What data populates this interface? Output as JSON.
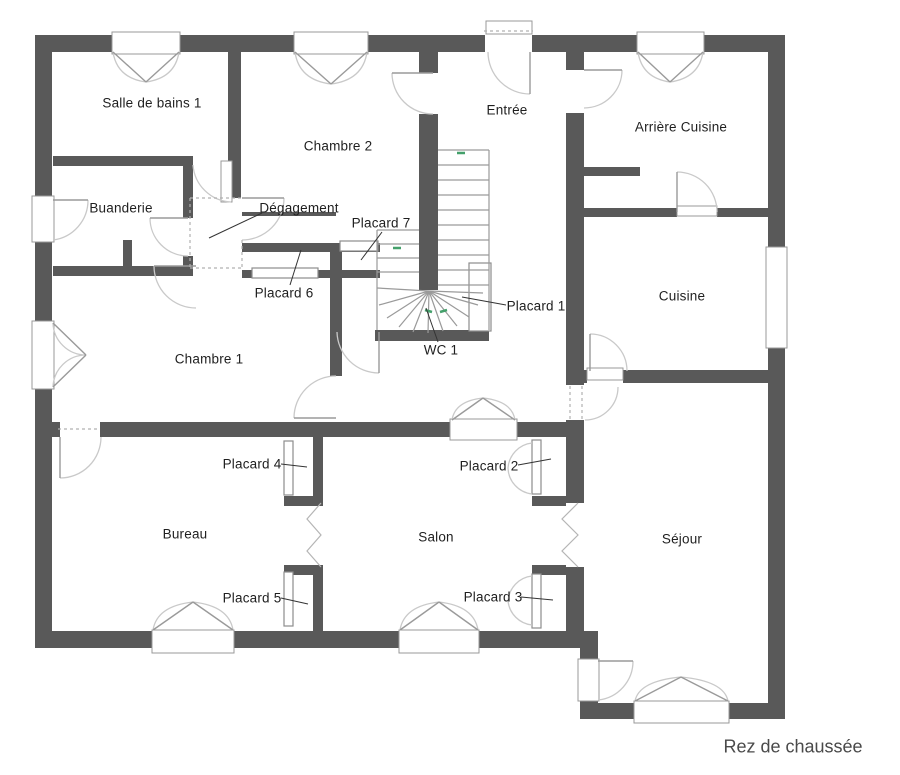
{
  "title": "Rez de chaussée",
  "colors": {
    "wall": "#595959",
    "door_arc": "#c9c9c9",
    "door_leaf": "#9a9a9a",
    "window_border": "#999999",
    "stair_line": "#9a9a9a",
    "direction_mark": "#44a06b",
    "label_text": "#1f1f1f",
    "title_text": "#4a4a4a",
    "background": "#ffffff"
  },
  "rooms": [
    {
      "label": "Salle de bains 1"
    },
    {
      "label": "Chambre 2"
    },
    {
      "label": "Entrée"
    },
    {
      "label": "Arrière Cuisine"
    },
    {
      "label": "Buanderie"
    },
    {
      "label": "Dégagement"
    },
    {
      "label": "Placard 7"
    },
    {
      "label": "Placard 6"
    },
    {
      "label": "Placard 1"
    },
    {
      "label": "Cuisine"
    },
    {
      "label": "Chambre 1"
    },
    {
      "label": "WC 1"
    },
    {
      "label": "Placard 4"
    },
    {
      "label": "Placard 2"
    },
    {
      "label": "Bureau"
    },
    {
      "label": "Salon"
    },
    {
      "label": "Séjour"
    },
    {
      "label": "Placard 5"
    },
    {
      "label": "Placard 3"
    }
  ]
}
